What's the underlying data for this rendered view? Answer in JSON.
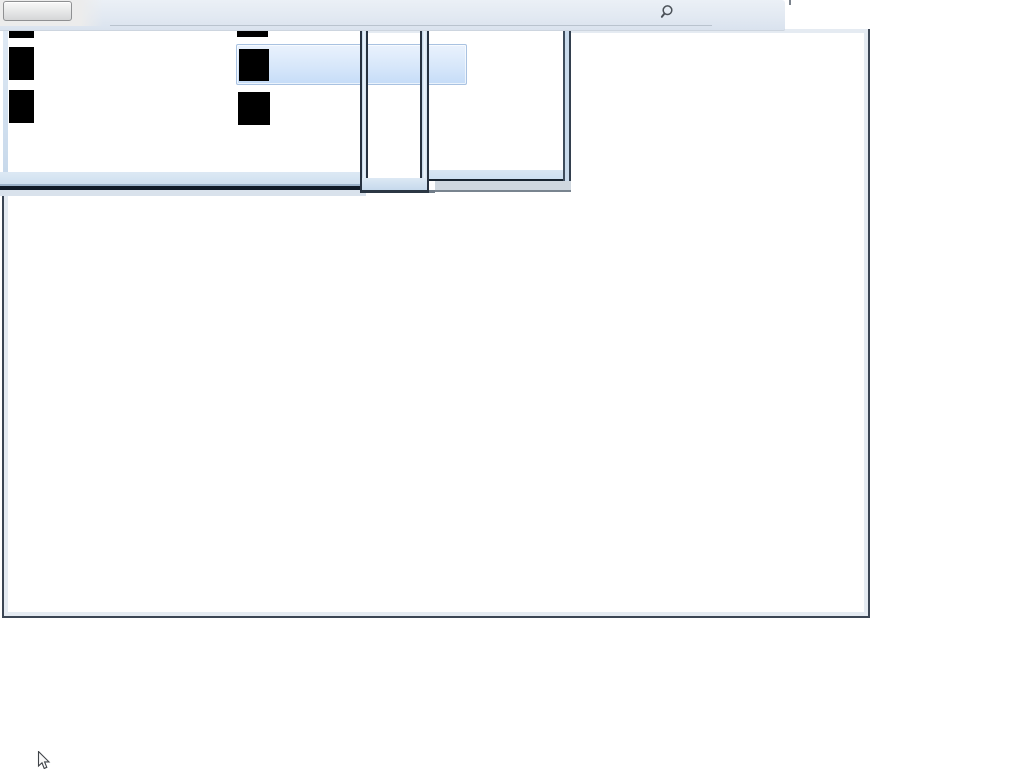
{
  "toolbar": {
    "button": {
      "label": ""
    },
    "search": {
      "icon": "magnifier-icon"
    }
  },
  "menus": {
    "left_panel": {
      "redacted_items": 3
    },
    "second_column": {
      "redacted_items": 3
    },
    "selected_item": {
      "label": "",
      "state": "hovered"
    }
  },
  "cursor": {
    "icon": "arrow-cursor"
  },
  "colors": {
    "topbar_gradient_top": "#ebf0f6",
    "topbar_gradient_bottom": "#d9e2ee",
    "topbar_left_cap": "#ececec",
    "toolbar_button_border": "#8f9092",
    "window_border": "#3c4654",
    "window_inner_edge": "#e5ebf2",
    "panel_edge_blue": "#c9daeb",
    "panel_dark_edge": "#101b28",
    "highlight_border": "#a9c2e1",
    "highlight_fill_top": "#eaf2fd",
    "highlight_fill_bottom": "#c6dcf7",
    "redacted_icon": "#000000",
    "drop_shadow_gray": "#cfd7df"
  }
}
